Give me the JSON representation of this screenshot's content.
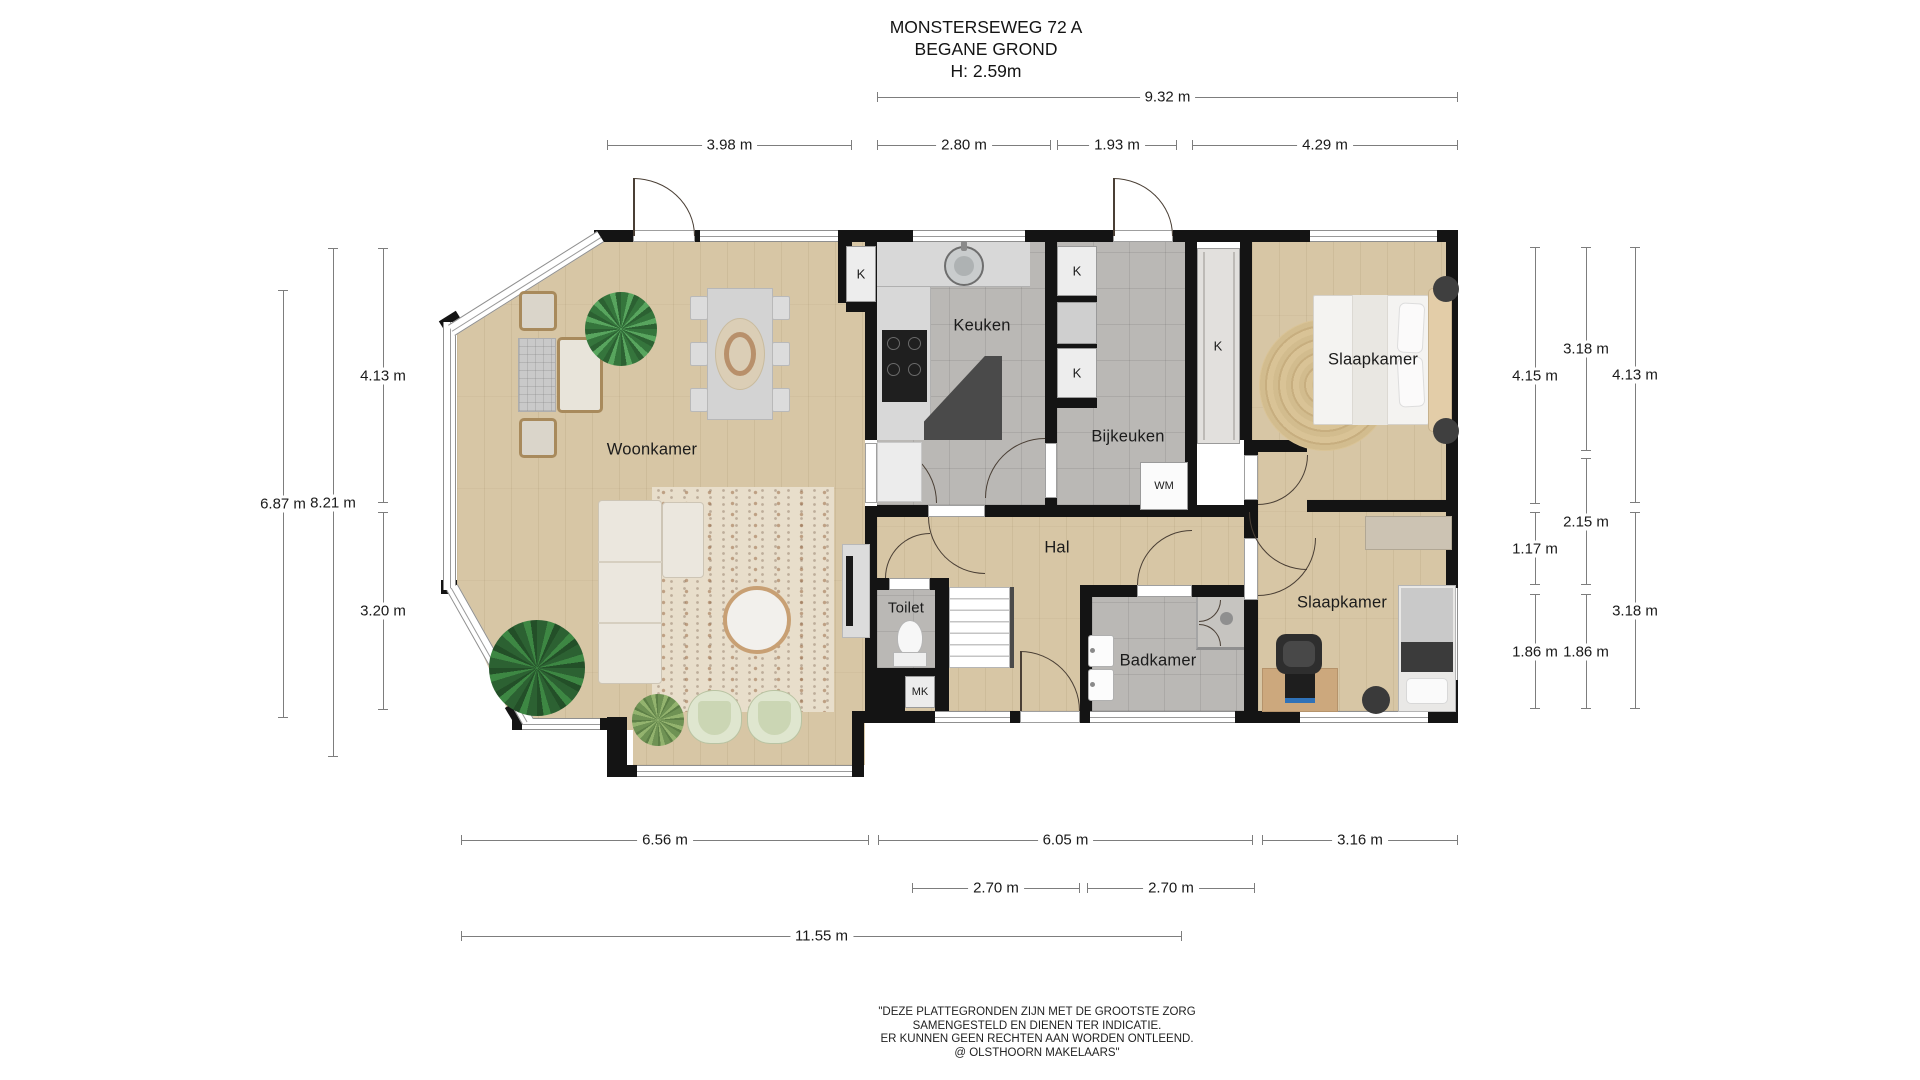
{
  "title": {
    "address": "MONSTERSEWEG 72 A",
    "floor": "BEGANE GROND",
    "ceiling_height": "H: 2.59m"
  },
  "rooms": {
    "woonkamer": "Woonkamer",
    "keuken": "Keuken",
    "bijkeuken": "Bijkeuken",
    "slaapkamer_1": "Slaapkamer",
    "slaapkamer_2": "Slaapkamer",
    "hal": "Hal",
    "toilet": "Toilet",
    "badkamer": "Badkamer"
  },
  "fixtures": {
    "closet_woonkamer": "K",
    "closet_bijkeuken_top": "K",
    "closet_bijkeuken_mid": "K",
    "closet_tall": "K",
    "meterkast": "MK",
    "wasmachine": "WM"
  },
  "dims": {
    "top_total": "9.32 m",
    "top_woonkamer": "3.98 m",
    "top_keuken": "2.80 m",
    "top_bijkeuken": "1.93 m",
    "top_slaapkamer": "4.29 m",
    "left_upper": "4.13 m",
    "left_lower": "3.20 m",
    "left_inner": "6.87 m",
    "left_outer": "8.21 m",
    "right_col1_top": "4.15 m",
    "right_col1_mid": "1.17 m",
    "right_col1_bottom": "1.86 m",
    "right_col2_top": "3.18 m",
    "right_col2_mid": "2.15 m",
    "right_col2_bottom": "1.86 m",
    "right_col3_top": "4.13 m",
    "right_col3_bottom": "3.18 m",
    "bottom_woonkamer": "6.56 m",
    "bottom_hal": "6.05 m",
    "bottom_slaapkamer": "3.16 m",
    "bottom_entree_left": "2.70 m",
    "bottom_entree_right": "2.70 m",
    "bottom_total": "11.55 m"
  },
  "footer": {
    "line1": "\"DEZE PLATTEGRONDEN ZIJN MET DE GROOTSTE ZORG",
    "line2": "SAMENGESTELD EN DIENEN TER INDICATIE.",
    "line3": "ER KUNNEN GEEN RECHTEN AAN WORDEN ONTLEEND.",
    "line4": "@ OLSTHOORN MAKELAARS\""
  },
  "palette": {
    "wall": "#141414",
    "wood_floor": "#d7c6a5",
    "tile_floor": "#bab8b5",
    "dimension_line": "#7d7d7d",
    "door_swing": "#4a3f35"
  }
}
